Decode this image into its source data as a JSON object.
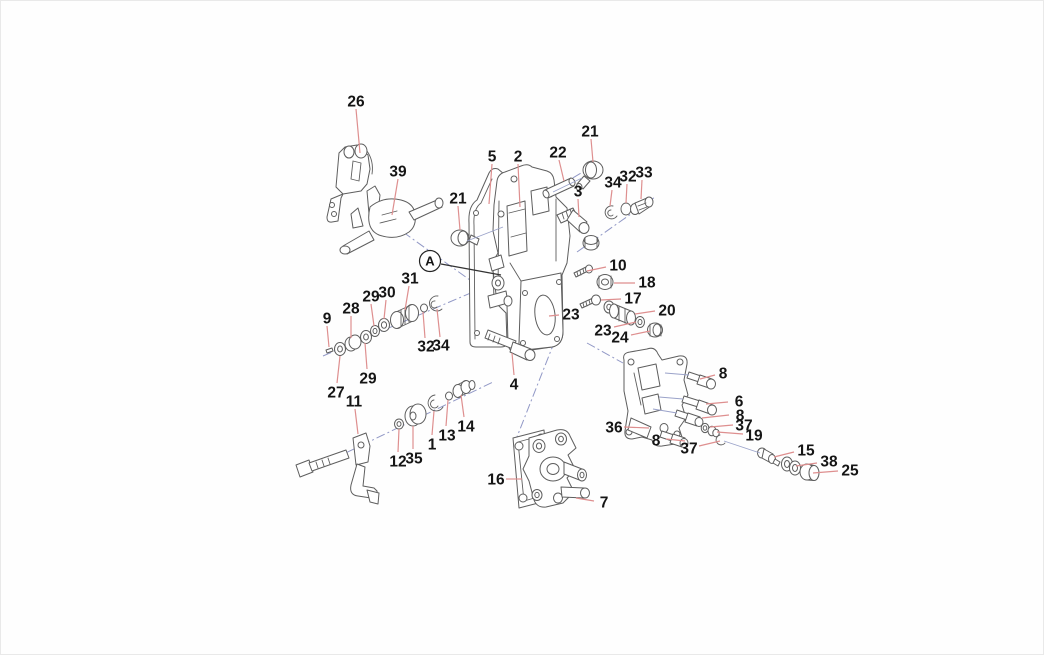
{
  "canvas": {
    "width": 1044,
    "height": 655,
    "viewbox": "0 0 1044 655",
    "background": "#fefefe"
  },
  "colors": {
    "label": "#151515",
    "leader": "#de8f8f",
    "leader_black": "#333333",
    "outline": "#5e5e5e",
    "axis": "#9198c6",
    "assembly": "#9aa2c9",
    "circle_stroke": "#222222"
  },
  "callouts": [
    {
      "id": "c26",
      "label": "26",
      "x": 355,
      "y": 100,
      "line": [
        355,
        108,
        359,
        152
      ]
    },
    {
      "id": "c39",
      "label": "39",
      "x": 397,
      "y": 170,
      "line": [
        397,
        178,
        391,
        214
      ]
    },
    {
      "id": "c5",
      "label": "5",
      "x": 491,
      "y": 155,
      "line": [
        491,
        163,
        488,
        203
      ]
    },
    {
      "id": "c2",
      "label": "2",
      "x": 517,
      "y": 155,
      "line": [
        517,
        163,
        519,
        206
      ]
    },
    {
      "id": "c21a",
      "label": "21",
      "x": 457,
      "y": 197,
      "line": [
        457,
        205,
        459,
        229
      ]
    },
    {
      "id": "c22",
      "label": "22",
      "x": 557,
      "y": 151,
      "line": [
        558,
        159,
        563,
        180
      ]
    },
    {
      "id": "c21b",
      "label": "21",
      "x": 589,
      "y": 130,
      "line": [
        590,
        138,
        592,
        161
      ]
    },
    {
      "id": "c3",
      "label": "3",
      "x": 577,
      "y": 190,
      "line": [
        577,
        198,
        578,
        216
      ]
    },
    {
      "id": "c34a",
      "label": "34",
      "x": 612,
      "y": 181,
      "line": [
        611,
        189,
        609,
        205
      ]
    },
    {
      "id": "c32a",
      "label": "32",
      "x": 627,
      "y": 175,
      "line": [
        626,
        183,
        625,
        202
      ]
    },
    {
      "id": "c33",
      "label": "33",
      "x": 643,
      "y": 171,
      "line": [
        641,
        179,
        640,
        198
      ]
    },
    {
      "id": "c10",
      "label": "10",
      "x": 617,
      "y": 264,
      "line": [
        605,
        266,
        586,
        270
      ]
    },
    {
      "id": "c18",
      "label": "18",
      "x": 646,
      "y": 281,
      "line": [
        634,
        282,
        613,
        282
      ]
    },
    {
      "id": "c17",
      "label": "17",
      "x": 632,
      "y": 297,
      "line": [
        620,
        298,
        600,
        299
      ]
    },
    {
      "id": "c20",
      "label": "20",
      "x": 666,
      "y": 309,
      "line": [
        654,
        310,
        634,
        313
      ]
    },
    {
      "id": "c23a",
      "label": "23",
      "x": 570,
      "y": 313,
      "line": [
        558,
        314,
        548,
        315
      ]
    },
    {
      "id": "c23b",
      "label": "23",
      "x": 602,
      "y": 329,
      "line": [
        613,
        326,
        635,
        321
      ]
    },
    {
      "id": "c24",
      "label": "24",
      "x": 619,
      "y": 336,
      "line": [
        630,
        334,
        649,
        330
      ]
    },
    {
      "id": "c4",
      "label": "4",
      "x": 513,
      "y": 383,
      "line": [
        513,
        374,
        511,
        352
      ]
    },
    {
      "id": "c31",
      "label": "31",
      "x": 409,
      "y": 277,
      "line": [
        408,
        285,
        404,
        309
      ]
    },
    {
      "id": "c30",
      "label": "30",
      "x": 386,
      "y": 291,
      "line": [
        385,
        299,
        383,
        318
      ]
    },
    {
      "id": "c29a",
      "label": "29",
      "x": 370,
      "y": 295,
      "line": [
        370,
        303,
        373,
        325
      ]
    },
    {
      "id": "c28",
      "label": "28",
      "x": 350,
      "y": 307,
      "line": [
        350,
        315,
        350,
        337
      ]
    },
    {
      "id": "c9",
      "label": "9",
      "x": 326,
      "y": 317,
      "line": [
        326,
        325,
        328,
        346
      ]
    },
    {
      "id": "c32b",
      "label": "32",
      "x": 425,
      "y": 345,
      "line": [
        424,
        337,
        422,
        311
      ]
    },
    {
      "id": "c34b",
      "label": "34",
      "x": 440,
      "y": 344,
      "line": [
        439,
        336,
        436,
        308
      ]
    },
    {
      "id": "c29b",
      "label": "29",
      "x": 367,
      "y": 377,
      "line": [
        366,
        368,
        364,
        342
      ]
    },
    {
      "id": "c27",
      "label": "27",
      "x": 335,
      "y": 391,
      "line": [
        336,
        382,
        339,
        355
      ]
    },
    {
      "id": "c11",
      "label": "11",
      "x": 353,
      "y": 400,
      "line": [
        354,
        408,
        357,
        433
      ]
    },
    {
      "id": "c12",
      "label": "12",
      "x": 397,
      "y": 460,
      "line": [
        397,
        451,
        398,
        428
      ]
    },
    {
      "id": "c35",
      "label": "35",
      "x": 413,
      "y": 457,
      "line": [
        412,
        448,
        412,
        425
      ]
    },
    {
      "id": "c1",
      "label": "1",
      "x": 431,
      "y": 443,
      "line": [
        431,
        434,
        433,
        410
      ]
    },
    {
      "id": "c13",
      "label": "13",
      "x": 446,
      "y": 434,
      "line": [
        445,
        425,
        447,
        399
      ]
    },
    {
      "id": "c14",
      "label": "14",
      "x": 465,
      "y": 425,
      "line": [
        463,
        416,
        460,
        394
      ]
    },
    {
      "id": "c16",
      "label": "16",
      "x": 495,
      "y": 478,
      "line": [
        505,
        478,
        521,
        478
      ]
    },
    {
      "id": "c7",
      "label": "7",
      "x": 603,
      "y": 501,
      "line": [
        593,
        500,
        575,
        497
      ]
    },
    {
      "id": "c36",
      "label": "36",
      "x": 613,
      "y": 426,
      "line": [
        623,
        426,
        648,
        427
      ]
    },
    {
      "id": "c8a",
      "label": "8",
      "x": 722,
      "y": 372,
      "line": [
        714,
        374,
        699,
        378
      ]
    },
    {
      "id": "c6",
      "label": "6",
      "x": 738,
      "y": 400,
      "line": [
        727,
        401,
        705,
        403
      ]
    },
    {
      "id": "c8b",
      "label": "8",
      "x": 739,
      "y": 414,
      "line": [
        728,
        414,
        701,
        417
      ]
    },
    {
      "id": "c37a",
      "label": "37",
      "x": 743,
      "y": 424,
      "line": [
        732,
        424,
        709,
        426
      ]
    },
    {
      "id": "c19",
      "label": "19",
      "x": 753,
      "y": 434,
      "line": [
        742,
        433,
        716,
        431
      ]
    },
    {
      "id": "c8c",
      "label": "8",
      "x": 655,
      "y": 439,
      "line": [
        665,
        438,
        684,
        440
      ]
    },
    {
      "id": "c37b",
      "label": "37",
      "x": 688,
      "y": 447,
      "line": [
        698,
        445,
        719,
        440
      ]
    },
    {
      "id": "c15",
      "label": "15",
      "x": 805,
      "y": 449,
      "line": [
        793,
        451,
        773,
        456
      ]
    },
    {
      "id": "c38",
      "label": "38",
      "x": 828,
      "y": 460,
      "line": [
        816,
        462,
        795,
        465
      ]
    },
    {
      "id": "c25",
      "label": "25",
      "x": 849,
      "y": 469,
      "line": [
        837,
        470,
        812,
        472
      ]
    },
    {
      "id": "cA",
      "label": "A",
      "x": 429,
      "y": 260,
      "circled": true,
      "line": [
        440,
        263,
        500,
        274
      ],
      "line_color": "leader_black"
    }
  ],
  "axis_lines": [
    {
      "x1": 402,
      "y1": 231,
      "x2": 487,
      "y2": 292
    },
    {
      "x1": 322,
      "y1": 355,
      "x2": 472,
      "y2": 291
    },
    {
      "x1": 299,
      "y1": 474,
      "x2": 492,
      "y2": 381
    },
    {
      "x1": 560,
      "y1": 324,
      "x2": 512,
      "y2": 446
    },
    {
      "x1": 586,
      "y1": 342,
      "x2": 622,
      "y2": 362
    },
    {
      "x1": 576,
      "y1": 251,
      "x2": 654,
      "y2": 196
    },
    {
      "x1": 528,
      "y1": 203,
      "x2": 580,
      "y2": 172
    }
  ],
  "assembly_lines": [
    {
      "x1": 466,
      "y1": 240,
      "x2": 502,
      "y2": 226
    },
    {
      "x1": 581,
      "y1": 177,
      "x2": 552,
      "y2": 191
    },
    {
      "x1": 664,
      "y1": 372,
      "x2": 688,
      "y2": 374
    },
    {
      "x1": 658,
      "y1": 396,
      "x2": 682,
      "y2": 398
    },
    {
      "x1": 652,
      "y1": 408,
      "x2": 676,
      "y2": 412
    },
    {
      "x1": 723,
      "y1": 440,
      "x2": 759,
      "y2": 452
    }
  ]
}
